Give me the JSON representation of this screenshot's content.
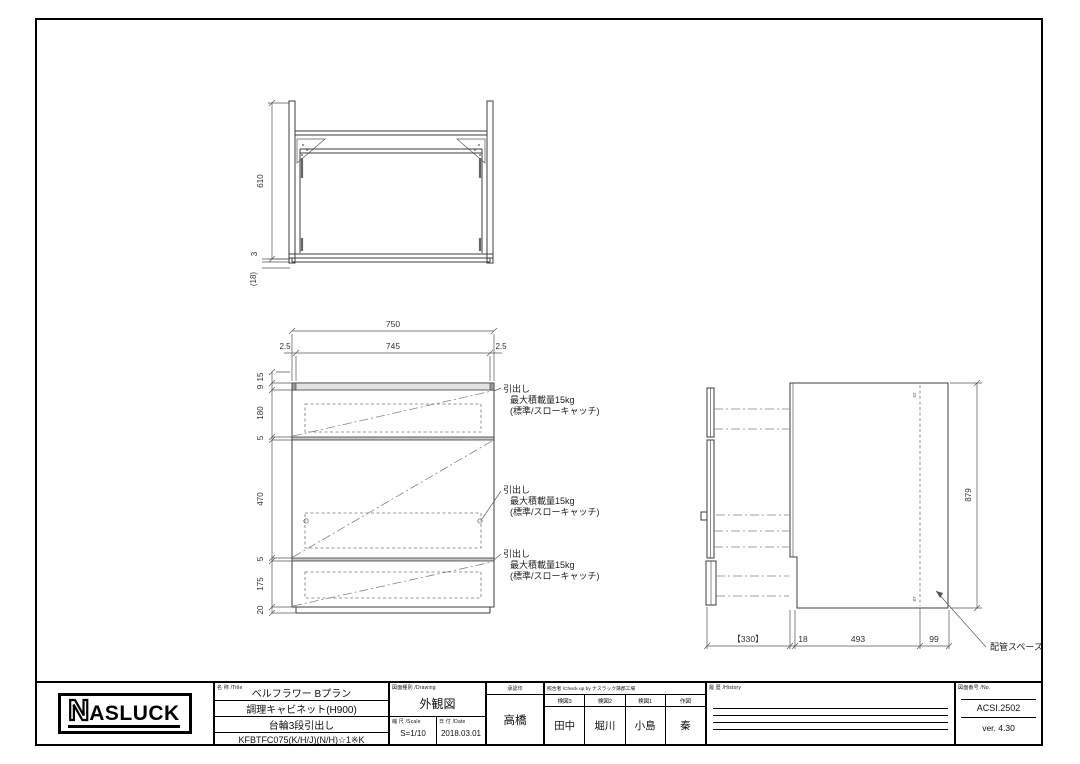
{
  "sheet": {
    "logo": {
      "n": "N",
      "rest": "ASLUCK"
    },
    "title": {
      "label": "名 称 /Title",
      "line1": "ベルフラワー Bプラン",
      "line2": "調理キャビネット(H900)",
      "line3": "台輪3段引出し",
      "line4": "KFBTFC075(K/H/J)(N/H)☆1※K"
    },
    "drawing_type": {
      "label": "図面種別 /Drawing",
      "value": "外観図"
    },
    "scale": {
      "label": "縮 尺 /Scale",
      "value": "S=1/10"
    },
    "date": {
      "label": "日 付 /Date",
      "value": "2018.03.01"
    },
    "approval": {
      "label": "承認印",
      "name": "高橋"
    },
    "check": {
      "label": "照合者 /Check up by ナスラック蒲郡工場",
      "columns": [
        {
          "role": "検図3",
          "name": "田中"
        },
        {
          "role": "検図2",
          "name": "堀川"
        },
        {
          "role": "検図1",
          "name": "小島"
        },
        {
          "role": "作図",
          "name": "秦"
        }
      ]
    },
    "history": {
      "label": "履 歴 /History"
    },
    "number": {
      "label": "図面番号 /No.",
      "value": "ACSI.2502",
      "version": "ver. 4.30"
    }
  },
  "top_view": {
    "dim_depth": "610",
    "dim_front": "3",
    "dim_overhang": "(18)"
  },
  "front_view": {
    "dim_width": "750",
    "dim_inner": "745",
    "dim_edge_left": "2.5",
    "dim_edge_right": "2.5",
    "dim_top1": "15",
    "dim_top2": "9",
    "dim_drawer1": "180",
    "dim_gap1": "5",
    "dim_drawer2": "470",
    "dim_gap2": "5",
    "dim_drawer3": "175",
    "dim_base": "20",
    "note": {
      "line1": "引出し",
      "line2": "最大積載量15kg",
      "line3": "(標準/スローキャッチ)"
    }
  },
  "side_view": {
    "dim_height": "879",
    "dim_pullout": "【330】",
    "dim_gap": "18",
    "dim_depth": "493",
    "dim_pipe": "99",
    "tick_top": "52",
    "tick_bottom": "87",
    "pipe_note": "配管スペース"
  }
}
